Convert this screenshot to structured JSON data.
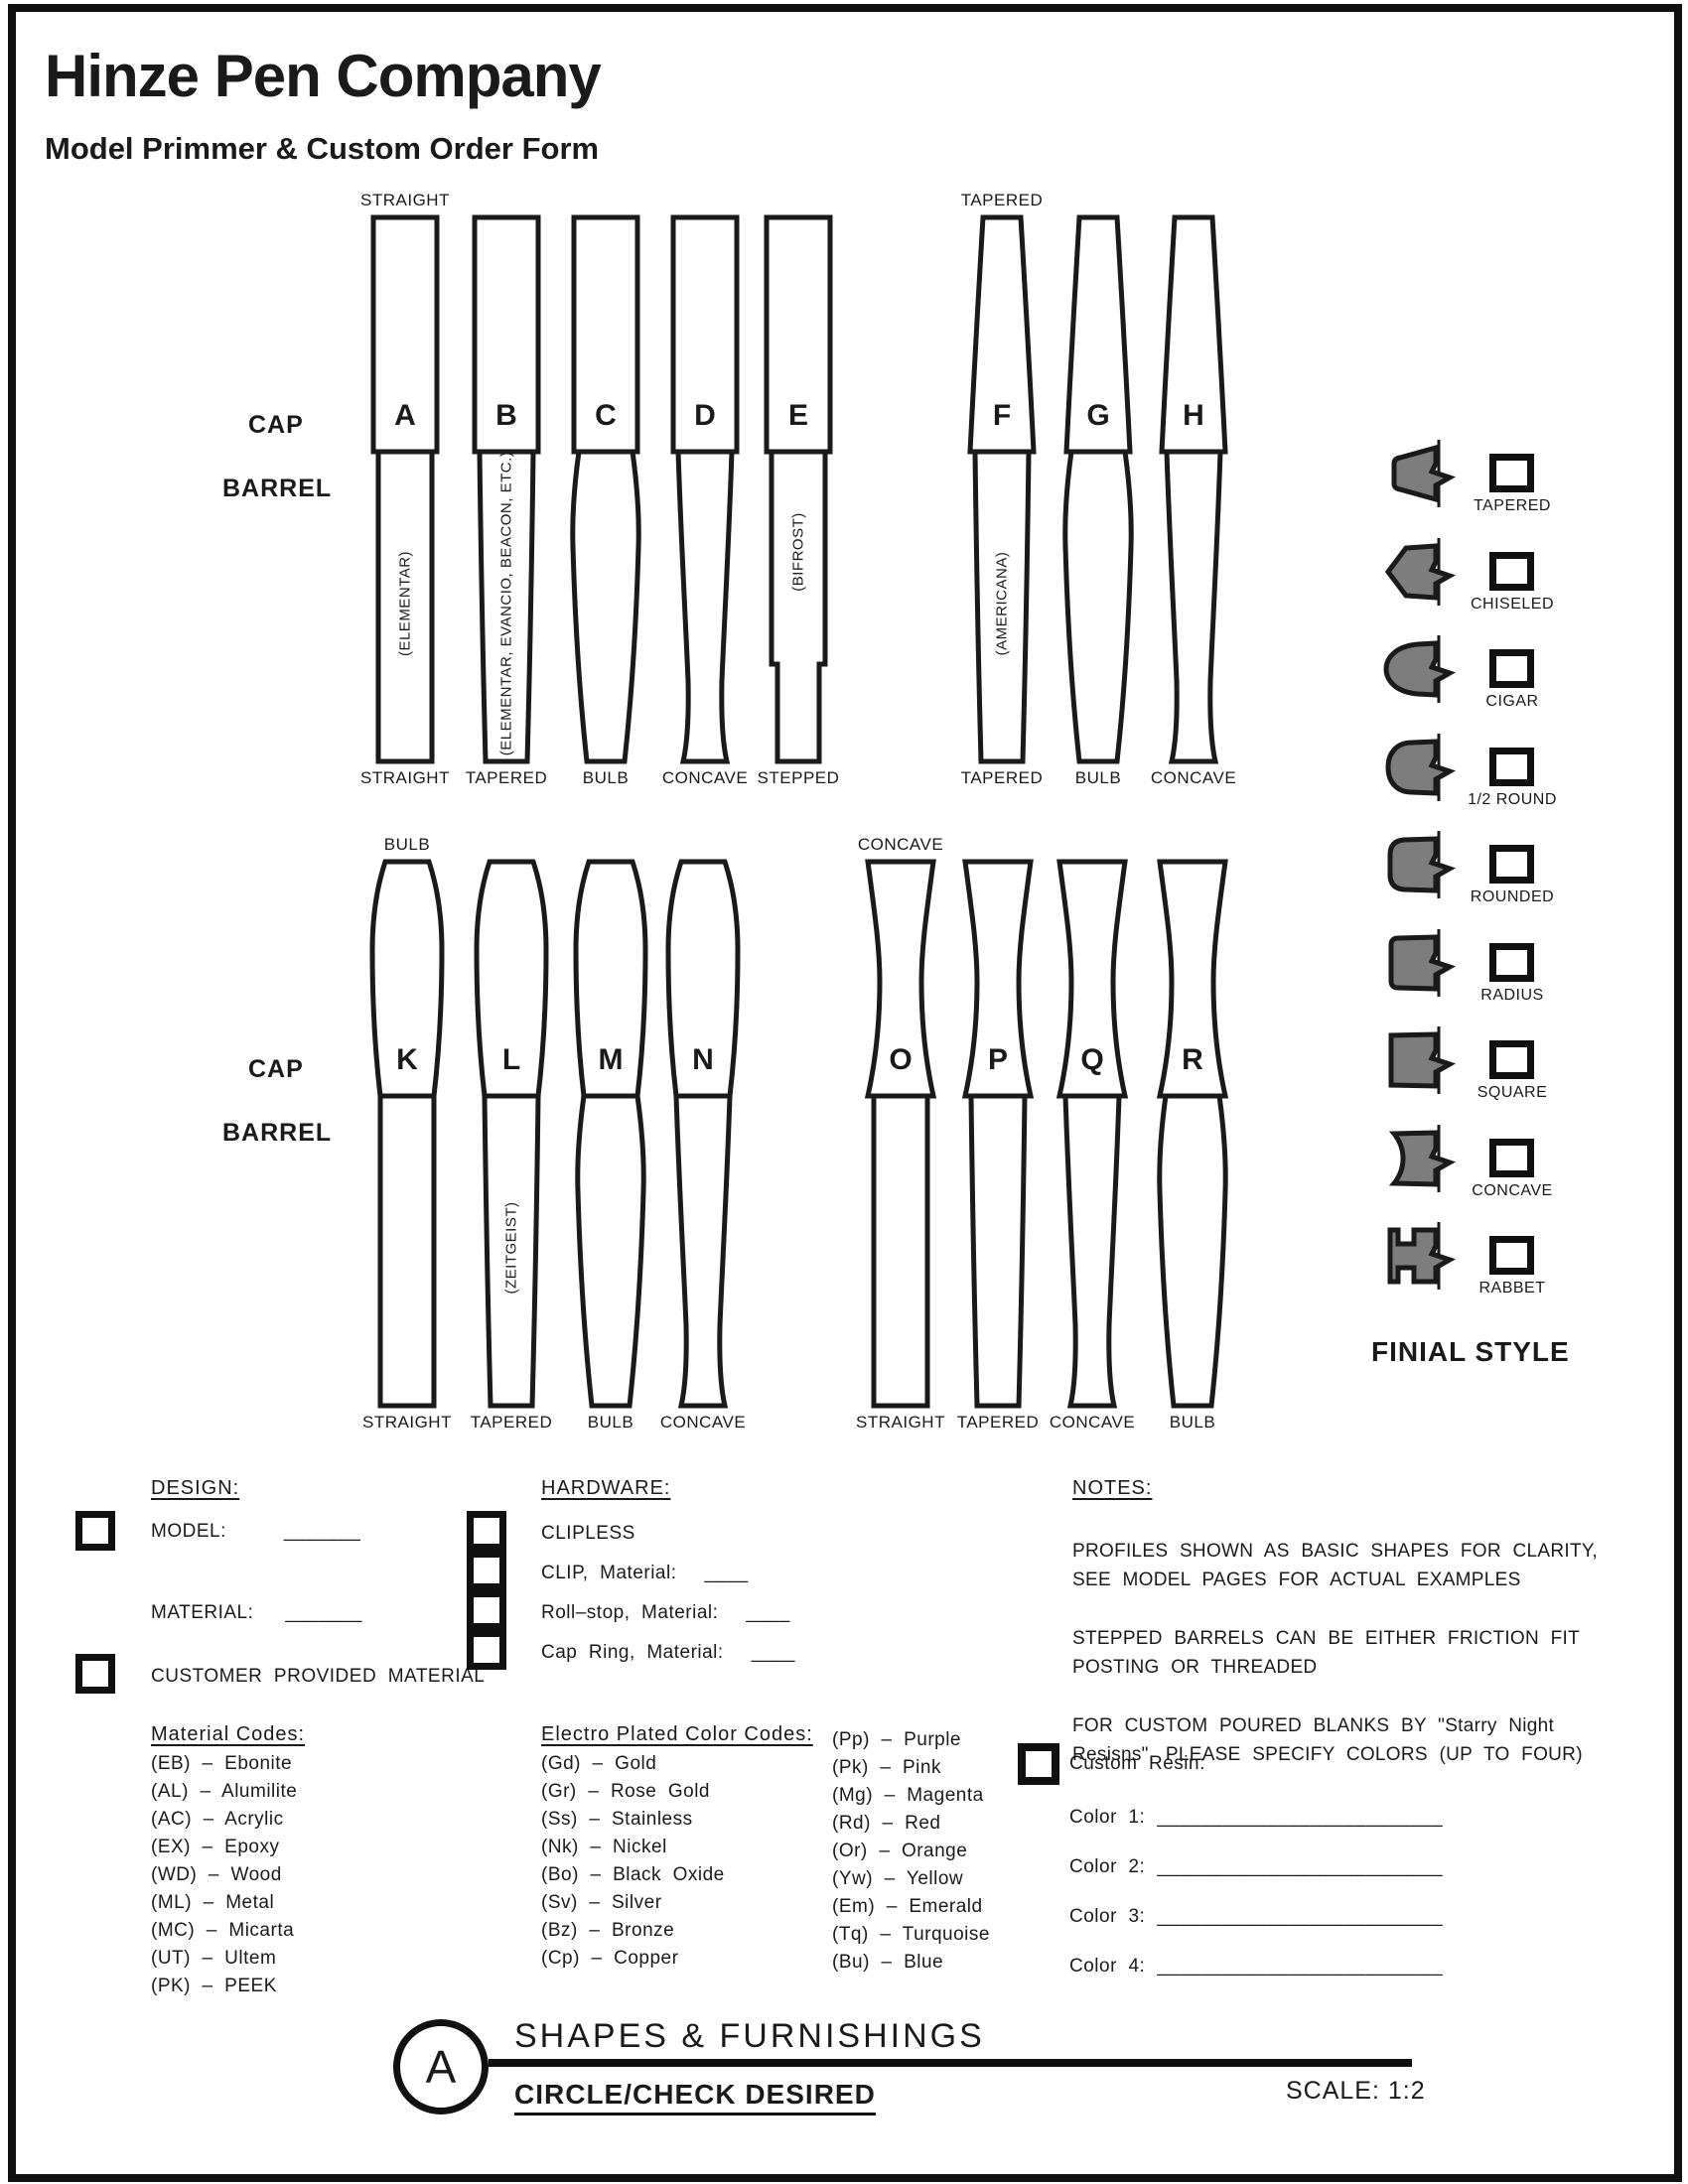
{
  "header": {
    "company": "Hinze Pen Company",
    "form_title": "Model Primmer & Custom Order Form"
  },
  "colors": {
    "ink": "#1a1a1a",
    "finial_gray": "#7d7d7d",
    "page_bg": "#ffffff"
  },
  "rows": [
    {
      "cap_label": "CAP",
      "barrel_label": "BARREL",
      "groups": [
        {
          "cap_type_label": "STRAIGHT",
          "pens": [
            {
              "letter": "A",
              "cap": "straight",
              "barrel": "straight",
              "label": "STRAIGHT",
              "note": "(ELEMENTAR)"
            },
            {
              "letter": "B",
              "cap": "straight",
              "barrel": "tapered",
              "label": "TAPERED",
              "note": "(ELEMENTAR, EVANCIO, BEACON, ETC.)"
            },
            {
              "letter": "C",
              "cap": "straight",
              "barrel": "bulb",
              "label": "BULB",
              "note": ""
            },
            {
              "letter": "D",
              "cap": "straight",
              "barrel": "concave",
              "label": "CONCAVE",
              "note": ""
            },
            {
              "letter": "E",
              "cap": "straight",
              "barrel": "stepped",
              "label": "STEPPED",
              "note": "(BIFROST)"
            }
          ]
        },
        {
          "cap_type_label": "TAPERED",
          "pens": [
            {
              "letter": "F",
              "cap": "tapered",
              "barrel": "tapered",
              "label": "TAPERED",
              "note": "(AMERICANA)"
            },
            {
              "letter": "G",
              "cap": "tapered",
              "barrel": "bulb",
              "label": "BULB",
              "note": ""
            },
            {
              "letter": "H",
              "cap": "tapered",
              "barrel": "concave",
              "label": "CONCAVE",
              "note": ""
            }
          ]
        }
      ]
    },
    {
      "cap_label": "CAP",
      "barrel_label": "BARREL",
      "groups": [
        {
          "cap_type_label": "BULB",
          "pens": [
            {
              "letter": "K",
              "cap": "bulb",
              "barrel": "straight",
              "label": "STRAIGHT",
              "note": ""
            },
            {
              "letter": "L",
              "cap": "bulb",
              "barrel": "tapered",
              "label": "TAPERED",
              "note": "(ZEITGEIST)"
            },
            {
              "letter": "M",
              "cap": "bulb",
              "barrel": "bulb",
              "label": "BULB",
              "note": ""
            },
            {
              "letter": "N",
              "cap": "bulb",
              "barrel": "concave",
              "label": "CONCAVE",
              "note": ""
            }
          ]
        },
        {
          "cap_type_label": "CONCAVE",
          "pens": [
            {
              "letter": "O",
              "cap": "concave",
              "barrel": "straight",
              "label": "STRAIGHT",
              "note": ""
            },
            {
              "letter": "P",
              "cap": "concave",
              "barrel": "tapered",
              "label": "TAPERED",
              "note": ""
            },
            {
              "letter": "Q",
              "cap": "concave",
              "barrel": "concave",
              "label": "CONCAVE",
              "note": ""
            },
            {
              "letter": "R",
              "cap": "concave",
              "barrel": "bulb",
              "label": "BULB",
              "note": ""
            }
          ]
        }
      ]
    }
  ],
  "finial": {
    "title": "FINIAL STYLE",
    "styles": [
      {
        "label": "TAPERED",
        "shape": "tapered"
      },
      {
        "label": "CHISELED",
        "shape": "chiseled"
      },
      {
        "label": "CIGAR",
        "shape": "cigar"
      },
      {
        "label": "1/2  ROUND",
        "shape": "half-round"
      },
      {
        "label": "ROUNDED",
        "shape": "rounded"
      },
      {
        "label": "RADIUS",
        "shape": "radius"
      },
      {
        "label": "SQUARE",
        "shape": "square"
      },
      {
        "label": "CONCAVE",
        "shape": "concave"
      },
      {
        "label": "RABBET",
        "shape": "rabbet"
      }
    ]
  },
  "design": {
    "heading": "DESIGN:",
    "model_label": "MODEL:",
    "model_value": "_______",
    "material_label": "MATERIAL:",
    "material_value": "_______",
    "customer_label": "CUSTOMER  PROVIDED  MATERIAL"
  },
  "material_codes": {
    "heading": "Material Codes:",
    "items": [
      "(EB)  –  Ebonite",
      "(AL)  –  Alumilite",
      "(AC)  –  Acrylic",
      "(EX)  –  Epoxy",
      "(WD)  –  Wood",
      "(ML)  –  Metal",
      "(MC)  –  Micarta",
      "(UT)  –  Ultem",
      "(PK)  –  PEEK"
    ]
  },
  "hardware": {
    "heading": "HARDWARE:",
    "items": [
      {
        "label": "CLIPLESS",
        "value": ""
      },
      {
        "label": "CLIP,  Material:",
        "value": "____"
      },
      {
        "label": "Roll–stop,  Material:",
        "value": "____"
      },
      {
        "label": "Cap  Ring,  Material:",
        "value": "____"
      }
    ]
  },
  "plating_codes": {
    "heading": "Electro  Plated  Color  Codes:",
    "col1": [
      "(Gd)  –  Gold",
      "(Gr)  –  Rose  Gold",
      "(Ss)  –  Stainless",
      "(Nk)  –  Nickel",
      "(Bo)  –  Black  Oxide",
      "(Sv)  –  Silver",
      "(Bz)  –  Bronze",
      "(Cp)  –  Copper"
    ],
    "col2": [
      "(Pp)  –  Purple",
      "(Pk)  –  Pink",
      "(Mg)  –  Magenta",
      "(Rd)  –  Red",
      "(Or)  –  Orange",
      "(Yw)  –  Yellow",
      "(Em)  –  Emerald",
      "(Tq)  –  Turquoise",
      "(Bu)  –  Blue"
    ]
  },
  "notes": {
    "heading": "NOTES:",
    "paragraphs": [
      "PROFILES SHOWN AS BASIC SHAPES FOR CLARITY, SEE MODEL PAGES FOR ACTUAL EXAMPLES",
      "STEPPED BARRELS CAN BE EITHER FRICTION FIT POSTING OR THREADED",
      "FOR CUSTOM POURED BLANKS BY \"Starry Night Resisns\", PLEASE SPECIFY COLORS (UP TO FOUR)"
    ]
  },
  "custom_resin": {
    "label": "Custom  Resin:",
    "colors": [
      {
        "label": "Color  1:",
        "value": "__________________________"
      },
      {
        "label": "Color  2:",
        "value": "__________________________"
      },
      {
        "label": "Color  3:",
        "value": "__________________________"
      },
      {
        "label": "Color  4:",
        "value": "__________________________"
      }
    ]
  },
  "title_block": {
    "detail_letter": "A",
    "title": "SHAPES  &  FURNISHINGS",
    "subtitle": "CIRCLE/CHECK  DESIRED",
    "scale": "SCALE:  1:2"
  }
}
